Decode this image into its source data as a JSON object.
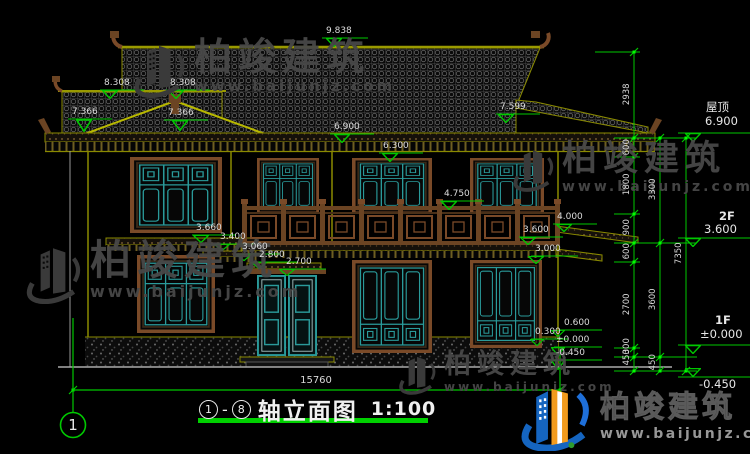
{
  "watermark": {
    "brand": "柏竣建筑",
    "url": "www.baijunjz.com"
  },
  "logo": {
    "brand": "柏竣建筑",
    "url": "www.baijunjz.com"
  },
  "title_block": {
    "axis_from": "1",
    "axis_to": "8",
    "dash": "-",
    "name": "轴立面图",
    "scale": "1:100"
  },
  "axis_bubble": {
    "label": "1"
  },
  "levels": {
    "roof": {
      "label": "屋顶",
      "value": "6.900"
    },
    "f2": {
      "label": "2F",
      "value": "3.600"
    },
    "f1": {
      "label": "1F",
      "value": "±0.000"
    },
    "ground": {
      "value": "-0.450"
    }
  },
  "dims": {
    "overall_width": "15760",
    "chain_inner": [
      "2938",
      "600",
      "1800",
      "900",
      "600",
      "2700",
      "300",
      "450"
    ],
    "chain_mid": [
      "3300",
      "3600",
      "450"
    ],
    "chain_outer": [
      "7350"
    ]
  },
  "marks": [
    "9.838",
    "8.308",
    "8.308",
    "7.366",
    "7.366",
    "7.599",
    "6.900",
    "6.300",
    "4.750",
    "4.000",
    "3.600",
    "3.660",
    "3.400",
    "3.060",
    "3.000",
    "2.800",
    "2.700",
    "0.600",
    "0.300",
    "±0.000",
    "-0.450"
  ],
  "colors": {
    "dim_green": "#00c800",
    "grip_green": "#00ff00",
    "line_olive": "#8a8a00",
    "frame_brown": "#7a4a28",
    "lattice_teal": "#2a9a9a",
    "text_white": "#e0e0e0",
    "logo_blue": "#1565c0",
    "logo_orange": "#f29b1d"
  }
}
